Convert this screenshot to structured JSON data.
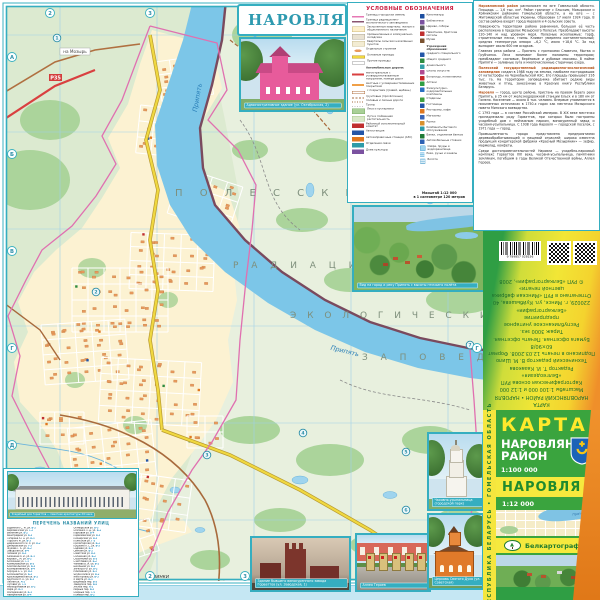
{
  "title_block": {
    "title": "НАРОВЛЯ"
  },
  "map": {
    "labels": {
      "l1": "П О Л Е С С К И Й",
      "l2": "Р А Д И А Ц И О Н Н О -",
      "l3": "Э К О Л О Г И Ч Е С К И Й",
      "l4": "З А П О В Е Д Н И К"
    },
    "river": "Припять",
    "village": "Физинки",
    "route_badge": "Р35",
    "dir_top": "на Мозырь",
    "dir_bottom": "на Александровку",
    "grid_marks": [
      {
        "t": "2",
        "x": 50,
        "y": 13
      },
      {
        "t": "3",
        "x": 150,
        "y": 13
      },
      {
        "t": "А",
        "x": 12,
        "y": 57
      },
      {
        "t": "Б",
        "x": 12,
        "y": 154
      },
      {
        "t": "В",
        "x": 12,
        "y": 251
      },
      {
        "t": "Г",
        "x": 12,
        "y": 348
      },
      {
        "t": "Д",
        "x": 12,
        "y": 445
      },
      {
        "t": "Г",
        "x": 477,
        "y": 348
      },
      {
        "t": "2",
        "x": 150,
        "y": 576
      },
      {
        "t": "3",
        "x": 245,
        "y": 576
      },
      {
        "t": "4",
        "x": 455,
        "y": 576
      }
    ],
    "poi": [
      {
        "n": "1",
        "x": 57,
        "y": 38
      },
      {
        "n": "2",
        "x": 96,
        "y": 292
      },
      {
        "n": "3",
        "x": 207,
        "y": 455
      },
      {
        "n": "4",
        "x": 303,
        "y": 433
      },
      {
        "n": "5",
        "x": 406,
        "y": 452
      },
      {
        "n": "6",
        "x": 406,
        "y": 510
      },
      {
        "n": "7",
        "x": 470,
        "y": 345
      }
    ]
  },
  "legend": {
    "title": "УСЛОВНЫЕ ОБОЗНАЧЕНИЯ",
    "left_items": [
      {
        "sw": "bnd-city",
        "label": "Границы городских земель"
      },
      {
        "sw": "bnd-res",
        "label": "Граница радиационно-экологического заповедника"
      },
      {
        "sw": "blk-live",
        "label": "Застроенные кварталы: жилые и общественного назначения"
      },
      {
        "sw": "blk-ind",
        "label": "промышленные и коммунально-складские"
      },
      {
        "sw": "blk-dacha",
        "label": "Кварталы сельских населённых пунктов"
      },
      {
        "sw": "one-bld",
        "label": "Отдельные строения"
      },
      {
        "sw": "rd-main-st",
        "label": "Основные проезды"
      },
      {
        "sw": "rd-st",
        "label": "Прочие проезды"
      },
      {
        "hdr": "true",
        "label": "Автомобильные дороги:"
      },
      {
        "sw": "rd-magistral",
        "label": "магистральные с усовершенствованным покрытием, номера дорог"
      },
      {
        "sw": "rd-local",
        "label": "местные с усовершенствованным покрытием"
      },
      {
        "sw": "rd-gravel",
        "label": "с покрытием (гравий, щебень)"
      },
      {
        "sw": "rd-ground",
        "label": "грунтовые (просёлочные)"
      },
      {
        "sw": "rd-field",
        "label": "полевые и лесные дороги"
      },
      {
        "sw": "trail",
        "label": "Тропы"
      },
      {
        "sw": "veg-forest",
        "label": "Леса и кустарники"
      },
      {
        "sw": "veg-meadow",
        "label": "Луга и пойменная растительность"
      },
      {
        "sw": "ic-admin",
        "c": "#c03030",
        "label": "Районный исполнительный комитет"
      },
      {
        "sw": "ic-bus",
        "c": "#2456a8",
        "label": "Автостанция"
      },
      {
        "sw": "ic-azs",
        "c": "#e07820",
        "label": "Автозаправочные станции (АЗС)"
      },
      {
        "sw": "ic-post",
        "c": "#2e9ba8",
        "label": "Отделения связи"
      },
      {
        "sw": "ic-dk",
        "c": "#7b52a0",
        "label": "Дома культуры"
      }
    ],
    "right_items": [
      {
        "c": "#1c4fa0",
        "label": "Кинотеатры"
      },
      {
        "c": "#7b52a0",
        "label": "Библиотеки"
      },
      {
        "c": "#5a5a5a",
        "label": "Церкви, соборы"
      },
      {
        "c": "#c03030",
        "label": "Памятники, братские могилы"
      },
      {
        "c": "#7a5230",
        "label": "Музеи"
      },
      {
        "hdr": "true",
        "label": "Учреждения образования:"
      },
      {
        "c": "#2457a8",
        "label": "среднего специального"
      },
      {
        "c": "#2e8b40",
        "label": "общего среднего"
      },
      {
        "c": "#35a0a8",
        "label": "дошкольного"
      },
      {
        "c": "#b04a90",
        "label": "школы искусств"
      },
      {
        "c": "#c62828",
        "label": "Больницы, поликлиники"
      },
      {
        "c": "#2e9e44",
        "label": "Аптеки"
      },
      {
        "c": "#2a6fc0",
        "label": "Физкультурно-оздоровительные комплексы"
      },
      {
        "c": "#3fa040",
        "label": "Стадионы"
      },
      {
        "c": "#2456a8",
        "label": "Гостиницы"
      },
      {
        "c": "#e07820",
        "label": "Рестораны, кафе"
      },
      {
        "c": "#3a66b8",
        "label": "Магазины"
      },
      {
        "c": "#d8902c",
        "label": "Рынки"
      },
      {
        "c": "#2e9ba8",
        "label": "Комбинаты бытового обслуживания"
      },
      {
        "c": "#1f7a36",
        "label": "Банки, отделения банков"
      },
      {
        "c": "#2d62b4",
        "label": "Автомобильные стоянки"
      },
      {
        "sw": "water",
        "label": "Озёра, пруды и водохранилища"
      },
      {
        "sw": "river",
        "label": "Реки, ручьи и каналы"
      },
      {
        "sw": "marsh",
        "label": "Болота"
      }
    ],
    "scale1": "Масштаб 1:12 000",
    "scale2": "в 1 сантиметре 120 метров"
  },
  "info": {
    "paragraphs": [
      {
        "lead": "Наровлянский район",
        "text": "расположен на юге Гомельской области. Площадь — 1,6 тыс. км². Район граничит с Ельским, Мозырским и Хойникским районами Гомельской области, а на юге — с Житомирской областью Украины. Образован 17 июля 1924 года. В состав района входят город Наровля и 4 сельских совета."
      },
      {
        "lead": "",
        "text": "Поверхность территории района равнинная, большая её часть расположена в пределах Мозырского Полесья. Преобладают высоты 120–140 м над уровнем моря. Полезные ископаемые: торф, строительные пески, глины. Климат умеренно континентальный; средняя температура января −6,2 °С, июля +18,6 °С. За год выпадает около 600 мм осадков."
      },
      {
        "lead": "",
        "text": "Главная река района — Припять с притоками Словечна, Мытва и Грубчанка. Леса занимают более половины территории; преобладают сосновые, берёзовые и дубовые массивы. В пойме Припяти — заливные луга и многочисленные старичные озёра."
      },
      {
        "lead": "Полесский государственный радиационно-экологический заповедник",
        "text": "создан в 1988 году на землях, наиболее пострадавших от катастрофы на Чернобыльской АЭС. Его площадь превышает 216 тыс. га. На территории заповедника обитают редкие виды животных и птиц, занесённые в Красную книгу Республики Беларусь."
      },
      {
        "lead": "Наровля",
        "text": "— город, центр района, пристань на правом берегу реки Припять, в 25 км от железнодорожной станции Ельск и в 180 км от Гомеля. Население — около 8 тыс. человек. Впервые упоминается в письменных источниках в 1750-х годах как местечко Мозырского повета Минского воеводства."
      },
      {
        "lead": "",
        "text": "С 1793 года — в составе Российской империи. В XIX веке местечко принадлежало роду Горваттов, при которых были построены усадебный дом с пейзажным парком, винокуренный завод и часовня-усыпальница. С 1938 года Наровля — городской посёлок, с 1971 года — город."
      },
      {
        "lead": "",
        "text": "Промышленность города представлена предприятиями деревообрабатывающей и пищевой отраслей; широко известна продукция кондитерской фабрики «Красный Мозырянин» — зефир, мармелад, конфеты."
      },
      {
        "lead": "",
        "text": "Среди достопримечательностей Наровли — усадебно-парковый комплекс Горваттов XIX века, часовня-усыпальница, памятники землякам, погибшим в годы Великой Отечественной войны, Аллея Героев."
      }
    ]
  },
  "photos": {
    "admin": "Административное здание (ул. Октябрьская, 2)",
    "aerial": "Вид на город и реку Припять с высоты птичьего полёта",
    "mansion": "Усадебный дом Горваттов — памятник архитектуры XIX века",
    "belltower": "Часовня-усыпальница (городской парк)",
    "church": "Церковь Святого Духа (ул. Советская)",
    "brick": "Здание бывшего винокуренного завода Горваттов (ул. Заводская, 1)",
    "memorial": "Аллея Героев"
  },
  "index": {
    "header": "ПЕРЕЧЕНЬ НАЗВАНИЙ УЛИЦ",
    "col1": [
      {
        "n": "Будённого С. М. ул.",
        "r": "В-2"
      },
      {
        "n": "Вербовичская ул.",
        "r": "Г-2"
      },
      {
        "n": "Весенняя ул.",
        "r": "Б-2"
      },
      {
        "n": "Виноградная ул.",
        "r": "Б-3"
      },
      {
        "n": "Гагарина Ю. А. ул.",
        "r": "В-3"
      },
      {
        "n": "Горького М. ул.",
        "r": "В-3"
      },
      {
        "n": "Дзержинского Ф. Э. ул.",
        "r": "В-2"
      },
      {
        "n": "Днепровская ул.",
        "r": "Г-3"
      },
      {
        "n": "Жукова Г. К. ул.",
        "r": "Б-2"
      },
      {
        "n": "Заводская ул.",
        "r": "В-4"
      },
      {
        "n": "Зелёная ул.",
        "r": "Б-3"
      },
      {
        "n": "Калинина М. И. ул.",
        "r": "В-3"
      },
      {
        "n": "Кирова С. М. ул.",
        "r": "В-2"
      },
      {
        "n": "Колхозная ул.",
        "r": "Г-3"
      },
      {
        "n": "Коммунальная ул.",
        "r": "В-3"
      },
      {
        "n": "Комсомольская ул.",
        "r": "В-3"
      },
      {
        "n": "Кооперативная ул.",
        "r": "В-4"
      },
      {
        "n": "Корзуна А. С. ул.",
        "r": "В-3"
      },
      {
        "n": "Космонавтов ул.",
        "r": "Б-3"
      },
      {
        "n": "Красноармейская ул.",
        "r": "В-2"
      },
      {
        "n": "Крупской Н. К. ул.",
        "r": "В-3"
      },
      {
        "n": "Лесная ул.",
        "r": "А-2"
      },
      {
        "n": "Луговая ул.",
        "r": "Г-4"
      },
      {
        "n": "Мелиоративная ул.",
        "r": "Б-2"
      },
      {
        "n": "Мира ул.",
        "r": "В-3"
      },
      {
        "n": "Молодёжная ул.",
        "r": "Б-3"
      },
      {
        "n": "Набережная ул.",
        "r": "В-4"
      },
      {
        "n": "Новая ул.",
        "r": "Б-2"
      },
      {
        "n": "Озёрная ул.",
        "r": "Г-4"
      }
    ],
    "col2": [
      {
        "n": "Октябрьская ул.",
        "r": "В-3"
      },
      {
        "n": "Осипенко П. Д. ул.",
        "r": "В-2"
      },
      {
        "n": "Парковая ул.",
        "r": "В-4"
      },
      {
        "n": "Первомайская ул.",
        "r": "В-3"
      },
      {
        "n": "Пионерская ул.",
        "r": "В-3"
      },
      {
        "n": "Полесская ул.",
        "r": "Г-3"
      },
      {
        "n": "Пролетарская ул.",
        "r": "В-2"
      },
      {
        "n": "Пушкина А. С. ул.",
        "r": "В-3"
      },
      {
        "n": "Садовая ул.",
        "r": "Б-3"
      },
      {
        "n": "Светлая ул.",
        "r": "Б-2"
      },
      {
        "n": "Советская ул.",
        "r": "В-3"
      },
      {
        "n": "Солнечная ул.",
        "r": "Б-2"
      },
      {
        "n": "Строителей ул.",
        "r": "Б-3"
      },
      {
        "n": "Счастливая ул.",
        "r": "Б-2"
      },
      {
        "n": "Чапаева В. И. ул.",
        "r": "В-2"
      },
      {
        "n": "Школьная ул.",
        "r": "В-3"
      },
      {
        "n": "Энгельса Ф. ул.",
        "r": "В-2"
      },
      {
        "n": "Юбилейная ул.",
        "r": "Б-3"
      },
      {
        "n": "Якуба Коласа ул.",
        "r": "В-2"
      },
      {
        "n": "Янки Купалы ул.",
        "r": "В-3"
      },
      {
        "n": "8 Марта ул.",
        "r": "В-3"
      },
      {
        "n": "Вишнёвый пер.",
        "r": "Б-3"
      },
      {
        "n": "Заводской пер.",
        "r": "В-4"
      },
      {
        "n": "Лесной пер.",
        "r": "А-2"
      },
      {
        "n": "Мирный пер.",
        "r": "В-3"
      },
      {
        "n": "Озёрный пер.",
        "r": "Г-4"
      },
      {
        "n": "Полевой пер.",
        "r": "Б-2"
      },
      {
        "n": "Речной пер.",
        "r": "В-4"
      },
      {
        "n": "Школьный пер.",
        "r": "В-3"
      }
    ]
  },
  "cover": {
    "spine": "РЕСПУБЛИКА БЕЛАРУСЬ   •   ГОМЕЛЬСКАЯ ОБЛАСТЬ",
    "karta": "КАРТА",
    "district": "НАРОВЛЯНСКИЙ РАЙОН",
    "scale_district": "1:100 000",
    "town": "НАРОВЛЯ",
    "scale_town": "1:12 000",
    "publisher": "Белкартография",
    "thumb_river": "Припять"
  },
  "back": {
    "barcode_number": "9 789857 028156",
    "imprint": [
      "КАРТА",
      "НАРОВЛЯНСКИЙ РАЙОН • НАРОВЛЯ",
      "Масштабы 1:100 000 и 1:12 000",
      "Картографическая основа РУП «Белгеодезия»",
      "Редактор Т. И. Казакова",
      "Технический редактор В. М. Шило",
      "Подписано в печать 12.03.2008. Формат 60×90/8",
      "Бумага офсетная. Печать офсетная. Тираж 3000 экз.",
      "Республиканское унитарное предприятие",
      "«Белкартография»",
      "220029, г. Минск, ул. Куйбышева, 40",
      "Отпечатано в РУП «Минская фабрика цветной печати»",
      "© РУП «Белкартография», 2008"
    ]
  }
}
